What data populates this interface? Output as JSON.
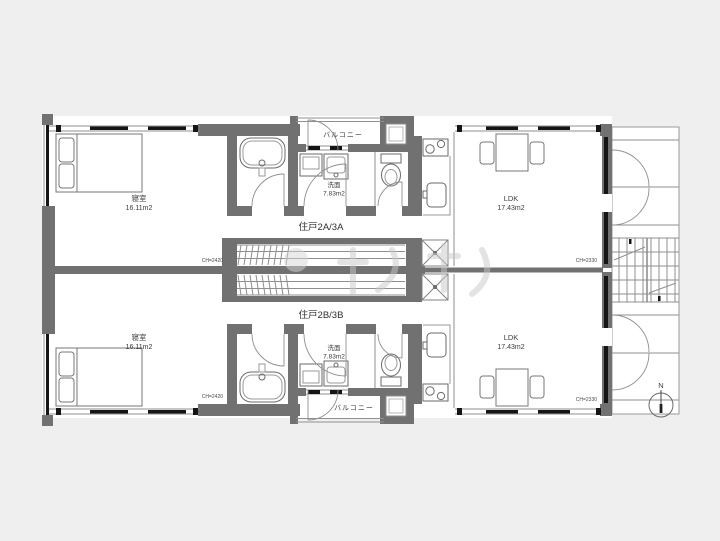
{
  "floor_plan": {
    "colors": {
      "background": "#efefef",
      "wall": "#717171",
      "line": "#8f8f8f",
      "frame_black": "#151515",
      "paper": "#ffffff"
    },
    "units": [
      {
        "label": "住戸2A/3A",
        "bedroom_label": "寝室",
        "bedroom_area": "16.11m2",
        "bedroom_ceiling": "CH=2420",
        "washroom_label": "洗面",
        "washroom_area": "7.83m2",
        "ldk_label": "LDK",
        "ldk_area": "17.43m2",
        "ldk_ceiling": "CH=2330",
        "balcony_label": "バルコニー"
      },
      {
        "label": "住戸2B/3B",
        "bedroom_label": "寝室",
        "bedroom_area": "16.11m2",
        "bedroom_ceiling": "CH=2420",
        "washroom_label": "洗面",
        "washroom_area": "7.83m2",
        "ldk_label": "LDK",
        "ldk_area": "17.43m2",
        "ldk_ceiling": "CH=2330",
        "balcony_label": "バルコニー"
      }
    ],
    "compass_label": "N"
  }
}
